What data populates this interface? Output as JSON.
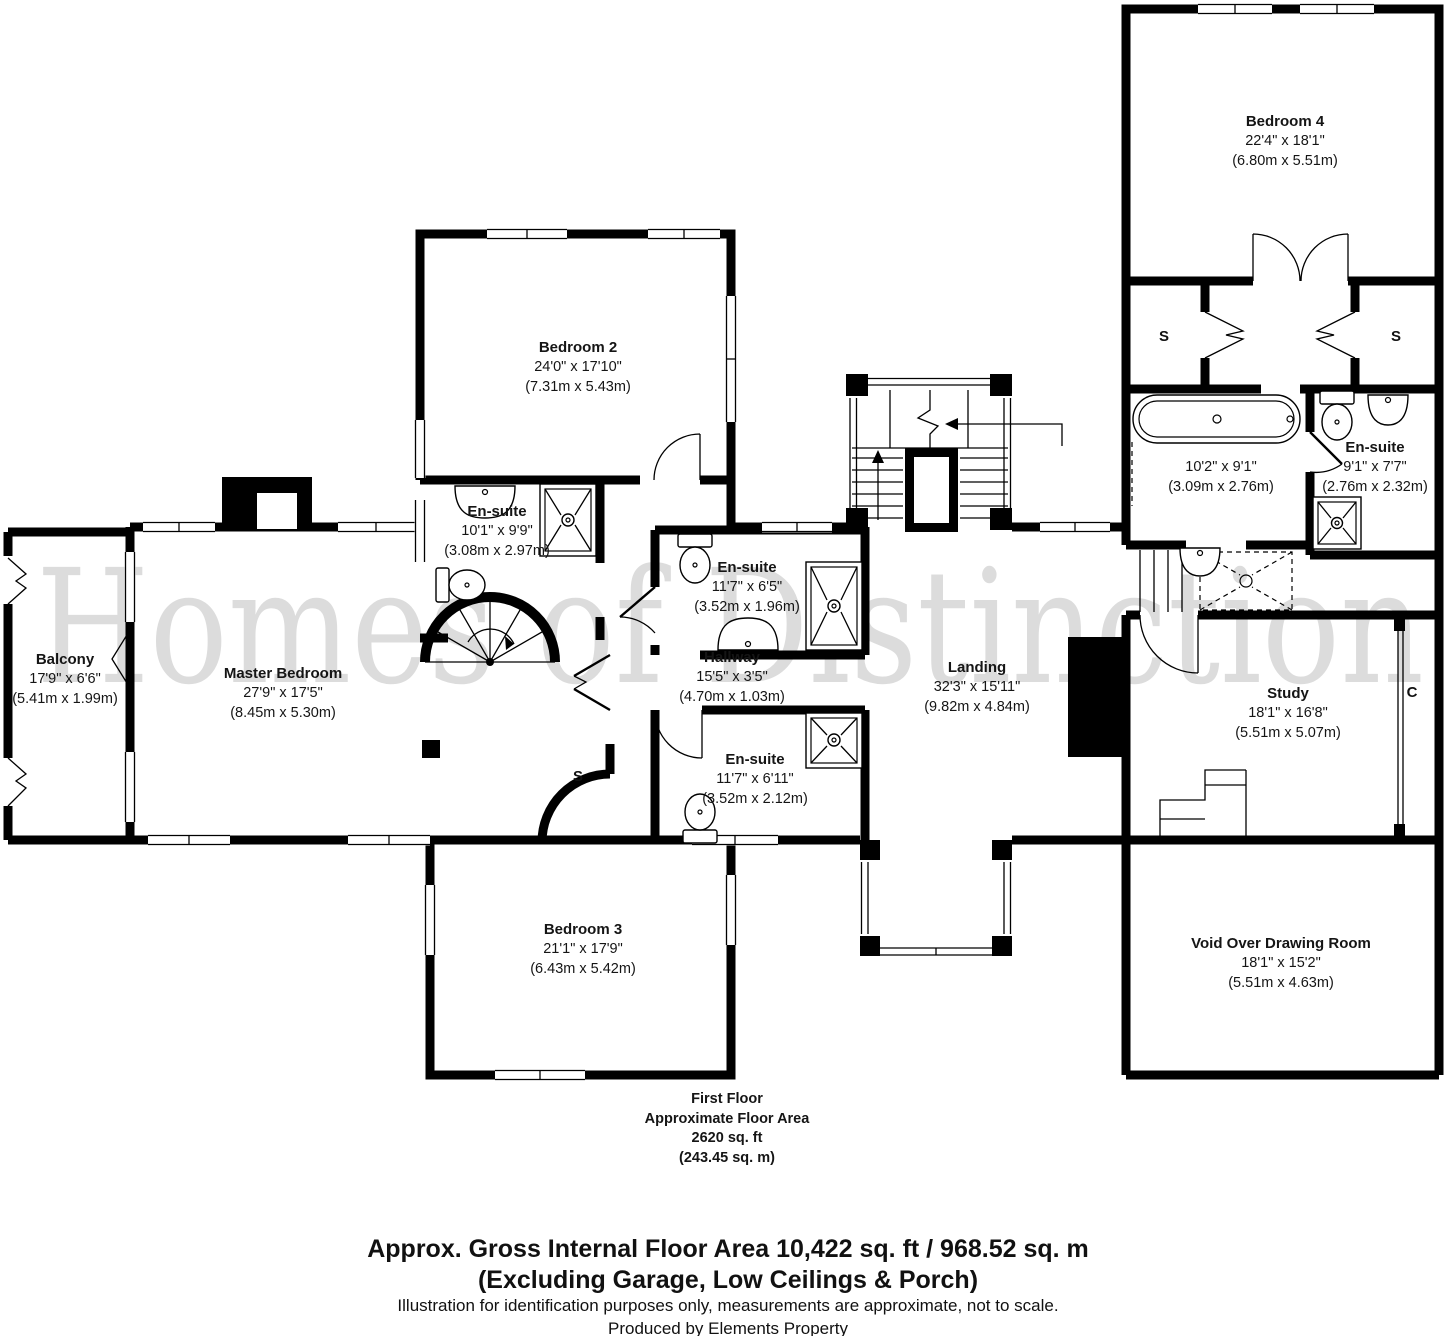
{
  "watermark": {
    "text": "Homes of Distinction"
  },
  "rooms": {
    "bedroom4": {
      "name": "Bedroom 4",
      "dims_ft": "22'4\" x 18'1\"",
      "dims_m": "(6.80m x 5.51m)"
    },
    "bedroom2": {
      "name": "Bedroom 2",
      "dims_ft": "24'0\" x 17'10\"",
      "dims_m": "(7.31m x 5.43m)"
    },
    "ensuite_master": {
      "name": "En-suite",
      "dims_ft": "10'1\" x 9'9\"",
      "dims_m": "(3.08m x 2.97m)"
    },
    "balcony": {
      "name": "Balcony",
      "dims_ft": "17'9\" x 6'6\"",
      "dims_m": "(5.41m x 1.99m)"
    },
    "master_bedroom": {
      "name": "Master Bedroom",
      "dims_ft": "27'9\" x 17'5\"",
      "dims_m": "(8.45m x 5.30m)"
    },
    "ensuite_a": {
      "name": "En-suite",
      "dims_ft": "11'7\" x 6'5\"",
      "dims_m": "(3.52m x 1.96m)"
    },
    "hallway": {
      "name": "Hallway",
      "dims_ft": "15'5\" x 3'5\"",
      "dims_m": "(4.70m x 1.03m)"
    },
    "landing": {
      "name": "Landing",
      "dims_ft": "32'3\" x 15'11\"",
      "dims_m": "(9.82m x 4.84m)"
    },
    "bathroom": {
      "name": "",
      "dims_ft": "10'2\" x 9'1\"",
      "dims_m": "(3.09m x 2.76m)"
    },
    "ensuite_right": {
      "name": "En-suite",
      "dims_ft": "9'1\" x 7'7\"",
      "dims_m": "(2.76m x 2.32m)"
    },
    "study": {
      "name": "Study",
      "dims_ft": "18'1\" x 16'8\"",
      "dims_m": "(5.51m x 5.07m)"
    },
    "ensuite_b": {
      "name": "En-suite",
      "dims_ft": "11'7\" x 6'11\"",
      "dims_m": "(3.52m x 2.12m)"
    },
    "bedroom3": {
      "name": "Bedroom 3",
      "dims_ft": "21'1\" x 17'9\"",
      "dims_m": "(6.43m x 5.42m)"
    },
    "void": {
      "name": "Void Over Drawing Room",
      "dims_ft": "18'1\" x 15'2\"",
      "dims_m": "(5.51m x 4.63m)"
    }
  },
  "markers": {
    "storage": "S",
    "cupboard": "C"
  },
  "floor_summary": {
    "line1": "First Floor",
    "line2": "Approximate Floor Area",
    "line3": "2620 sq. ft",
    "line4": "(243.45 sq. m)"
  },
  "footer": {
    "line1": "Approx. Gross Internal Floor Area 10,422 sq. ft / 968.52 sq. m",
    "line2": "(Excluding Garage, Low Ceilings & Porch)",
    "line3": "Illustration for identification purposes only, measurements are approximate, not to scale.",
    "line4": "Produced by Elements Property"
  },
  "colors": {
    "wall": "#000000",
    "watermark": "#dcdcdc",
    "background": "#ffffff"
  }
}
